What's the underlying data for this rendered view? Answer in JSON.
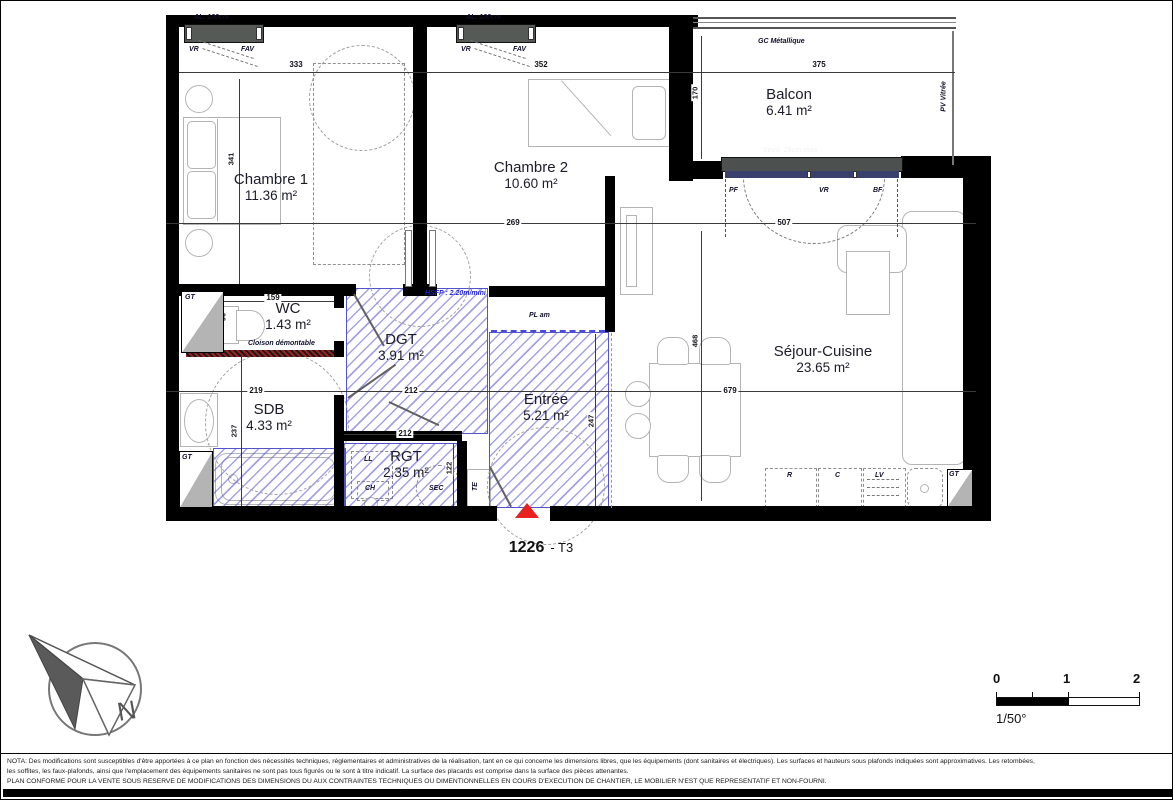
{
  "title": {
    "number": "1226",
    "type": "- T3"
  },
  "rooms": {
    "chambre1": {
      "name": "Chambre 1",
      "area": "11.36 m²"
    },
    "chambre2": {
      "name": "Chambre 2",
      "area": "10.60 m²"
    },
    "balcon": {
      "name": "Balcon",
      "area": "6.41 m²"
    },
    "wc": {
      "name": "WC",
      "area": "1.43 m²"
    },
    "dgt": {
      "name": "DGT",
      "area": "3.91 m²"
    },
    "sdb": {
      "name": "SDB",
      "area": "4.33 m²"
    },
    "rgt": {
      "name": "RGT",
      "area": "2.35 m²"
    },
    "entree": {
      "name": "Entrée",
      "area": "5.21 m²"
    },
    "sejour": {
      "name": "Séjour-Cuisine",
      "area": "23.65 m²"
    }
  },
  "annotations": {
    "al_window": "AL. 100cm",
    "vr": "VR",
    "fav": "FAV",
    "gc_metallique": "GC Métallique",
    "pv_vitree": "PV Vitrée",
    "seuil": "Seuil. 25cm max",
    "pf": "PF",
    "bf": "BF",
    "hsfp": "HSFP : 2.20m/mini",
    "pl_am": "PL am",
    "cloison": "Cloison démontable",
    "gt": "GT",
    "ll": "LL",
    "ch": "CH",
    "sec": "SEC",
    "te": "TE",
    "r": "R",
    "c": "C",
    "lv": "LV"
  },
  "dims": {
    "w_ch1": "333",
    "h_ch1": "341",
    "w_ch2": "352",
    "w_ch2b": "269",
    "w_balcon": "375",
    "h_balcon": "170",
    "w_bay": "507",
    "w_wc": "159",
    "d90": "90",
    "w_sdb": "219",
    "w_dgt": "212",
    "w_rgt": "212",
    "h_sdb": "237",
    "h_rgt": "122",
    "h_entree": "247",
    "h_sejour": "468",
    "w_sejour": "679"
  },
  "scalebar": {
    "zero": "0",
    "one": "1",
    "two": "2",
    "ratio": "1/50°"
  },
  "compass": {
    "north": "N"
  },
  "nota": {
    "line1": "NOTA: Des modifications sont susceptibles d'être apportées à ce plan en fonction des nécessités techniques, réglementaires et administratives de la réalisation, tant en ce qui concerne les dimensions libres, que les équipements (dont sanitaires et électriques). Les surfaces et hauteurs sous plafonds indiquées sont approximatives. Les retombées,",
    "line2": "les soffites, les faux-plafonds, ainsi que l'emplacement des équipements sanitaires ne sont pas tous figurés ou le sont à titre indicatif. La surface des placards est comprise dans la surface des pièces attenantes.",
    "line3": "PLAN CONFORME POUR LA VENTE SOUS RESERVE DE MODIFICATIONS DES DIMENSIONS DU AUX CONTRAINTES TECHNIQUES OU DIMENTIONNELLES EN COURS D'EXECUTION DE CHANTIER, LE MOBILIER N'EST QUE REPRESENTATIF ET NON-FOURNI."
  }
}
